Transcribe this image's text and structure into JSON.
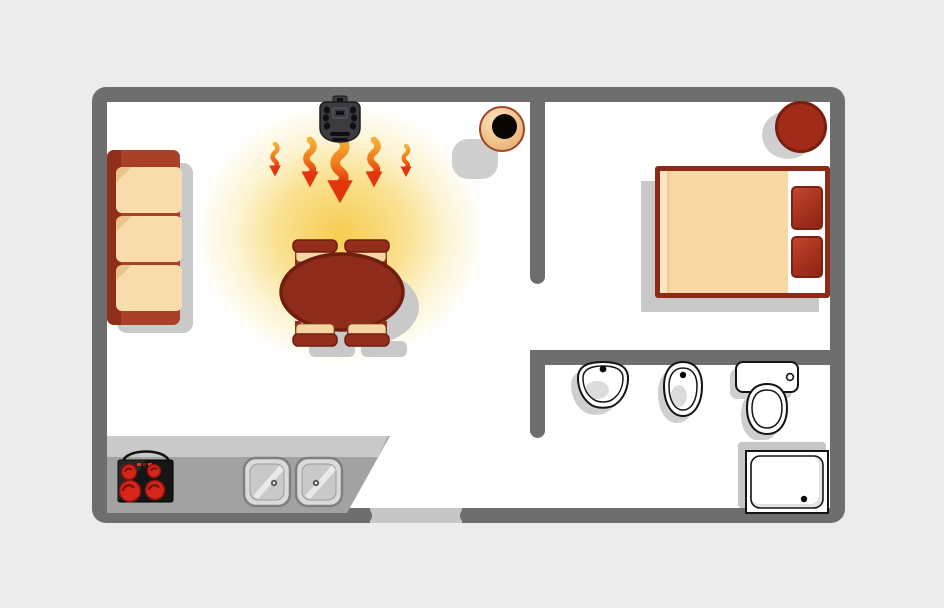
{
  "scene": {
    "kind": "apartment-floor-plan-top-view",
    "label": "Floor plan of a small apartment with a portable heater warming the living room"
  },
  "palette": {
    "background": "#ececec",
    "floor": "#ffffff",
    "wall": "#6e6e6e",
    "door_opening": "#c6c6c6",
    "furniture_red": "#a8402a",
    "furniture_red_dark": "#8e2b1a",
    "outline_red": "#6f1d0e",
    "cushion_cream": "#f8d8a4",
    "cushion_cream_light": "#fbe6c4",
    "glow_yellow": "#f6ca48",
    "flame_orange": "#f4a62e",
    "flame_red": "#e23210",
    "heater_body": "#3b3b41",
    "shadow_gray": "#c9c9c9",
    "stove_black": "#161616",
    "burner_red": "#d6251a",
    "fixture_white": "#ffffff",
    "fixture_outline": "#141414"
  },
  "rooms": {
    "living_room": {
      "label": "Living room with kitchen corner"
    },
    "bedroom": {
      "label": "Bedroom"
    },
    "bathroom": {
      "label": "Bathroom"
    }
  },
  "objects": {
    "heater": {
      "label": "Portable heater mounted at top wall blowing hot air downward",
      "room": "living_room"
    },
    "flames": {
      "label": "Wavy heat-flow arrows pointing down",
      "count": 5
    },
    "glow": {
      "label": "Warm yellow air glow around heater and table"
    },
    "sofa": {
      "label": "Three-seat sofa against left wall",
      "cushions": 3
    },
    "table": {
      "label": "Oval dark-red dining table with chairs",
      "chairs": 4
    },
    "pot": {
      "label": "Round plant pot near room divider"
    },
    "bed": {
      "label": "Double bed with cream blanket",
      "pillows": 2
    },
    "stool": {
      "label": "Round dark-red stool in bedroom corner"
    },
    "washbasin": {
      "label": "Bathroom washbasin"
    },
    "bidet": {
      "label": "Bidet"
    },
    "toilet": {
      "label": "Toilet with tank"
    },
    "shower": {
      "label": "Square shower tray with drain"
    },
    "counter": {
      "label": "Kitchen counter along bottom wall"
    },
    "stove": {
      "label": "Cooktop with glowing burners",
      "burners": 4
    },
    "kitchen_sink": {
      "label": "Double kitchen sink",
      "basins": 2
    },
    "entrance": {
      "label": "Entrance door opening in bottom wall"
    }
  }
}
